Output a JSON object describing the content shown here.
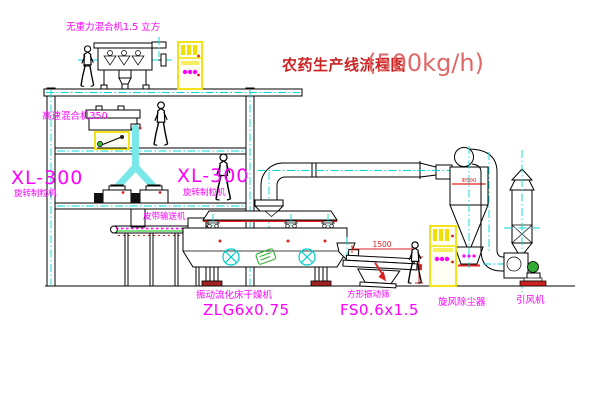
{
  "title": {
    "main": "农药生产线流程图",
    "capacity": "(500kg/h)"
  },
  "labels": {
    "gravity_mixer": "无重力混合机1.5 立方",
    "high_speed_mixer": "高速混合机350",
    "granulator_left_model": "XL-300",
    "granulator_left_name": "旋转制粒机",
    "granulator_right_model": "XL-300",
    "granulator_right_name": "旋转制粒机",
    "belt_conveyor": "皮带输送机",
    "dryer_name": "振动流化床干燥机",
    "dryer_model": "ZLG6x0.75",
    "screen_name": "方形振动筛",
    "screen_model": "FS0.6x1.5",
    "cyclone": "旋风除尘器",
    "fan": "引风机"
  },
  "dimensions": {
    "screen_width": "1500",
    "cyclone_diameter": "Φ500"
  },
  "colors": {
    "label_magenta": "#ff00ff",
    "title_red": "#cc2222",
    "capacity_red": "#e06868",
    "centerline_cyan": "#00d8d8",
    "cabinet_yellow": "#f0e000",
    "chute_cyan": "#7ae8e8",
    "line_black": "#000000",
    "accent_green": "#22aa22",
    "base_red": "#cc2222"
  }
}
